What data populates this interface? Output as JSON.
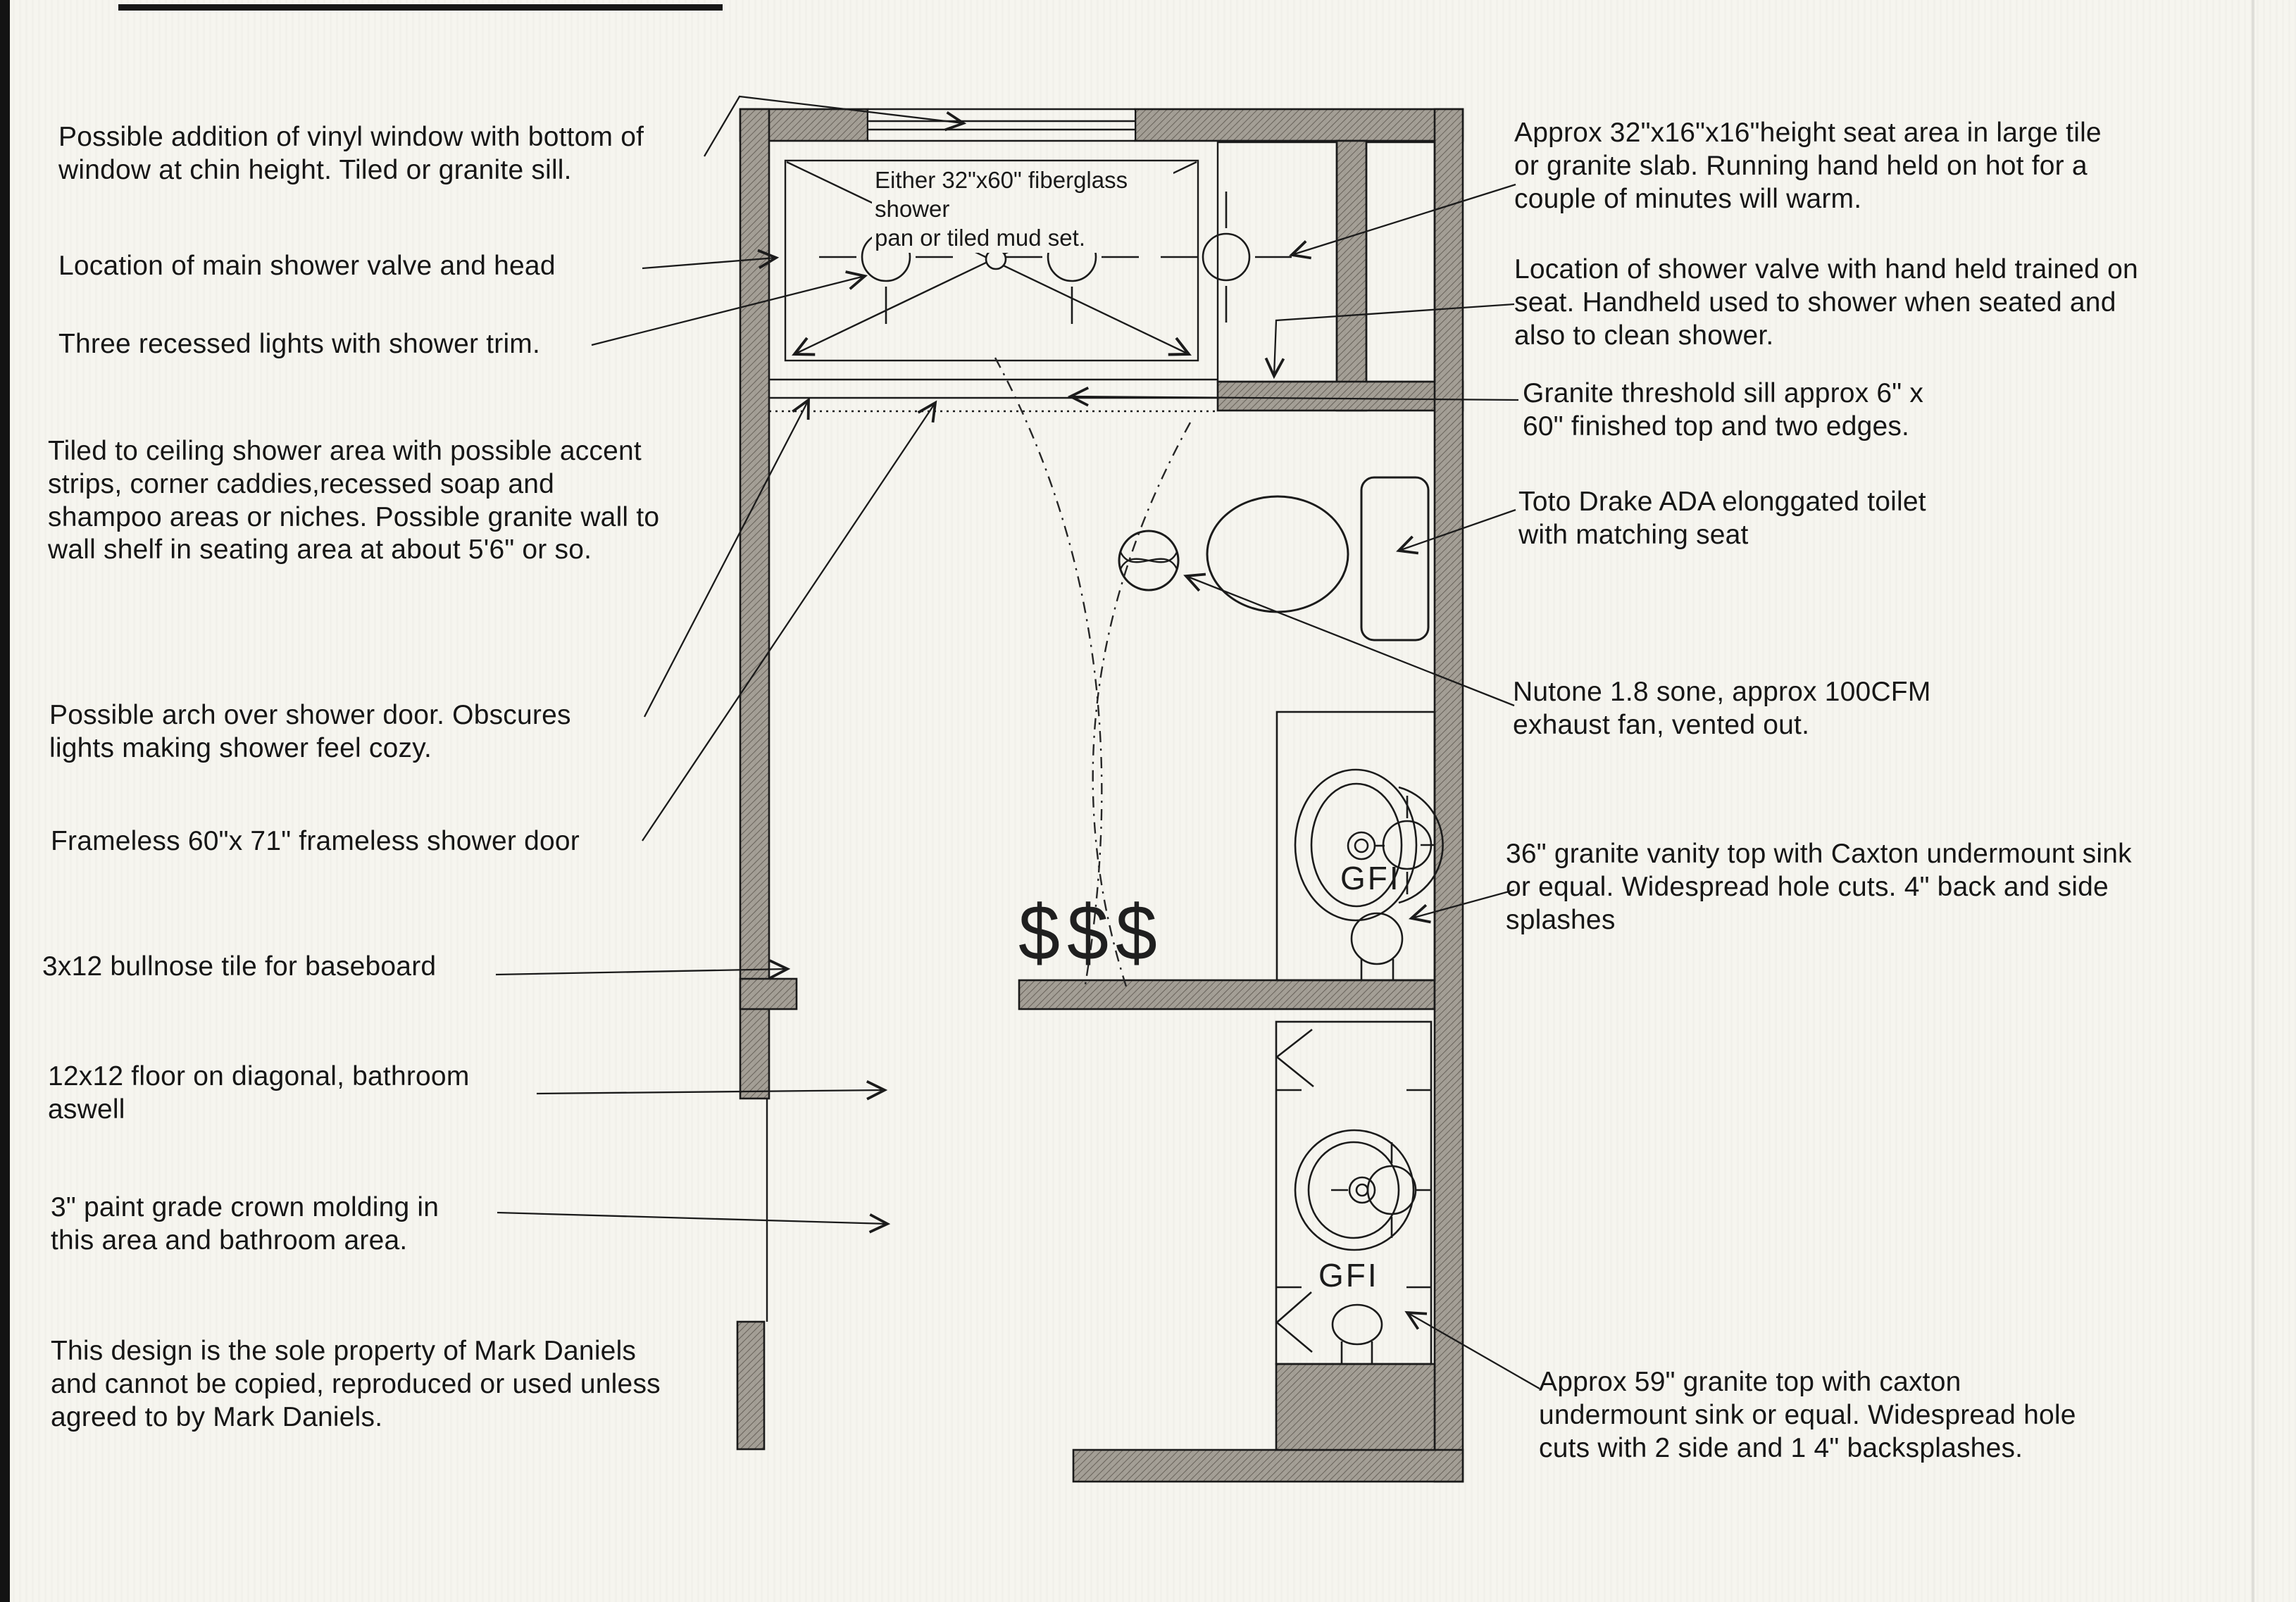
{
  "title": "Bathroom remodel floor plan sketch",
  "colors": {
    "paper": "#f6f5ef",
    "wall_fill": "#a49f96",
    "line": "#1b1b1b"
  },
  "notes_left": {
    "window": "Possible addition of vinyl window with bottom of\nwindow at chin height. Tiled or granite sill.",
    "valve": "Location of main shower valve and head",
    "lights": "Three recessed lights with shower trim.",
    "tiled": "Tiled to ceiling shower area with possible accent\nstrips, corner caddies,recessed soap and\nshampoo areas or niches. Possible granite wall to\nwall shelf in seating area at about 5'6\" or so.",
    "arch": "Possible arch over shower door. Obscures\nlights making shower feel cozy.",
    "frameless": "Frameless 60\"x 71\" frameless shower door",
    "bullnose": "3x12 bullnose tile for baseboard",
    "floor": "12x12 floor on diagonal, bathroom\naswell",
    "crown": "3\" paint grade crown molding in\nthis area and bathroom area.",
    "property": "This design is the sole property of Mark Daniels\nand cannot be copied, reproduced or used unless\nagreed to by Mark Daniels."
  },
  "notes_right": {
    "seat": "Approx 32\"x16\"x16\"height seat area in large tile\nor granite slab. Running hand held on hot for a\ncouple of minutes will warm.",
    "shower_valve": "Location of shower valve with hand held trained on\nseat. Handheld used to shower when seated and\nalso to clean shower.",
    "threshold": "Granite threshold sill approx 6\" x\n60\" finished top and two edges.",
    "toilet": "Toto Drake ADA elonggated toilet\nwith matching seat",
    "fan": "Nutone 1.8 sone, approx 100CFM\nexhaust fan, vented out.",
    "vanity36": "36\" granite vanity top with Caxton undermount sink\nor equal. Widespread hole cuts. 4\" back and side\nsplashes",
    "vanity59": "Approx 59\" granite top with caxton\nundermount sink or equal. Widespread hole\ncuts with 2 side and 1 4\" backsplashes."
  },
  "plan": {
    "pan_label": "Either 32\"x60\" fiberglass shower\npan or tiled mud set.",
    "gfi_upper": "GFI",
    "gfi_lower": "GFI",
    "dollars": "$$$"
  }
}
